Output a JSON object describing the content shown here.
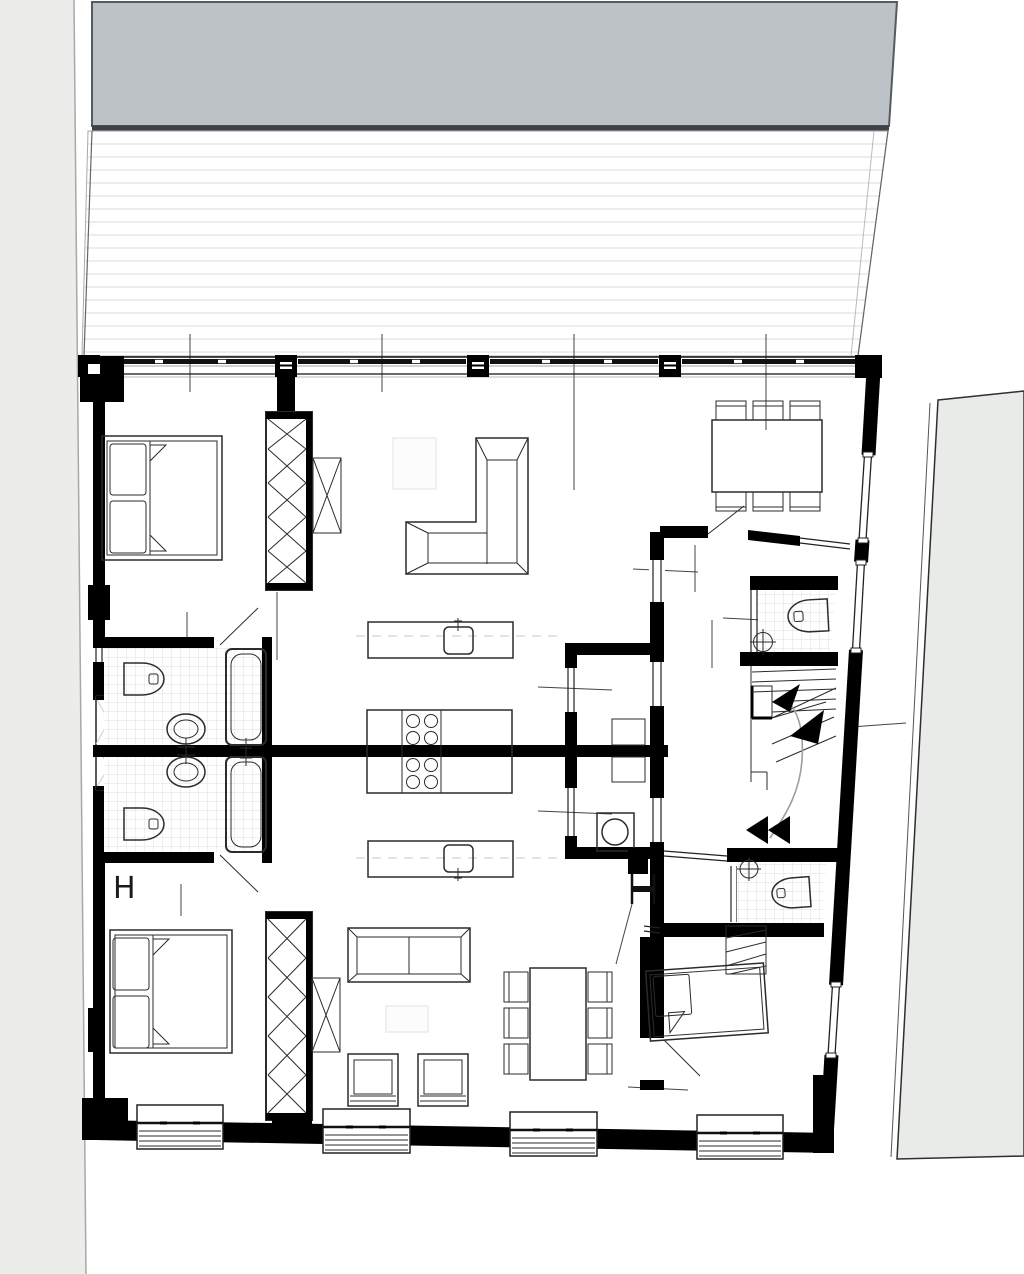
{
  "markers": {
    "left_label": "H"
  },
  "colors": {
    "background": "#ffffff",
    "walls": "#000000",
    "adjacent_roof_fill": "#bcc2c6",
    "adjacent_roof_edge": "#3d4248",
    "terrace_hatch_line": "#e9e9e9",
    "site_left_fill": "#ececea",
    "site_right_fill": "#e9ebe8",
    "tile_line": "#dedede",
    "furniture_line": "#2b2b2b",
    "walkline": "#9aa0a4"
  },
  "plan": {
    "type": "residential-floor-plan-two-mirrored-apartments",
    "site_elements": [
      "adjacent-building-roof",
      "terrace-decking",
      "left-parcel",
      "right-parcel"
    ],
    "upper_unit_elements": [
      "double-bed",
      "wardrobe-crossed",
      "side-cabinet-crossed",
      "l-shaped-sofa",
      "rug",
      "dining-table-six-chairs",
      "kitchen-island-with-sink",
      "cooktop-four-burners",
      "bathtub",
      "toilet",
      "washbasin",
      "shelf-unit",
      "wc-toilet",
      "wc-basin"
    ],
    "lower_unit_elements": [
      "double-bed",
      "wardrobe-crossed",
      "side-cabinet-crossed",
      "straight-sofa",
      "armchair",
      "armchair",
      "rug",
      "dining-table-six-chairs",
      "kitchen-island-with-sink",
      "cooktop-four-burners",
      "bathtub",
      "toilet",
      "washbasin",
      "washing-machine",
      "single-bed",
      "wardrobe-hatched",
      "wc-toilet",
      "wc-basin"
    ],
    "circulation_elements": [
      "winder-staircase",
      "direction-arrow-up",
      "direction-arrow-down",
      "walk-line"
    ],
    "shell_elements": [
      "window-band-with-columns",
      "french-window",
      "duct-shaft",
      "party-wall"
    ]
  }
}
